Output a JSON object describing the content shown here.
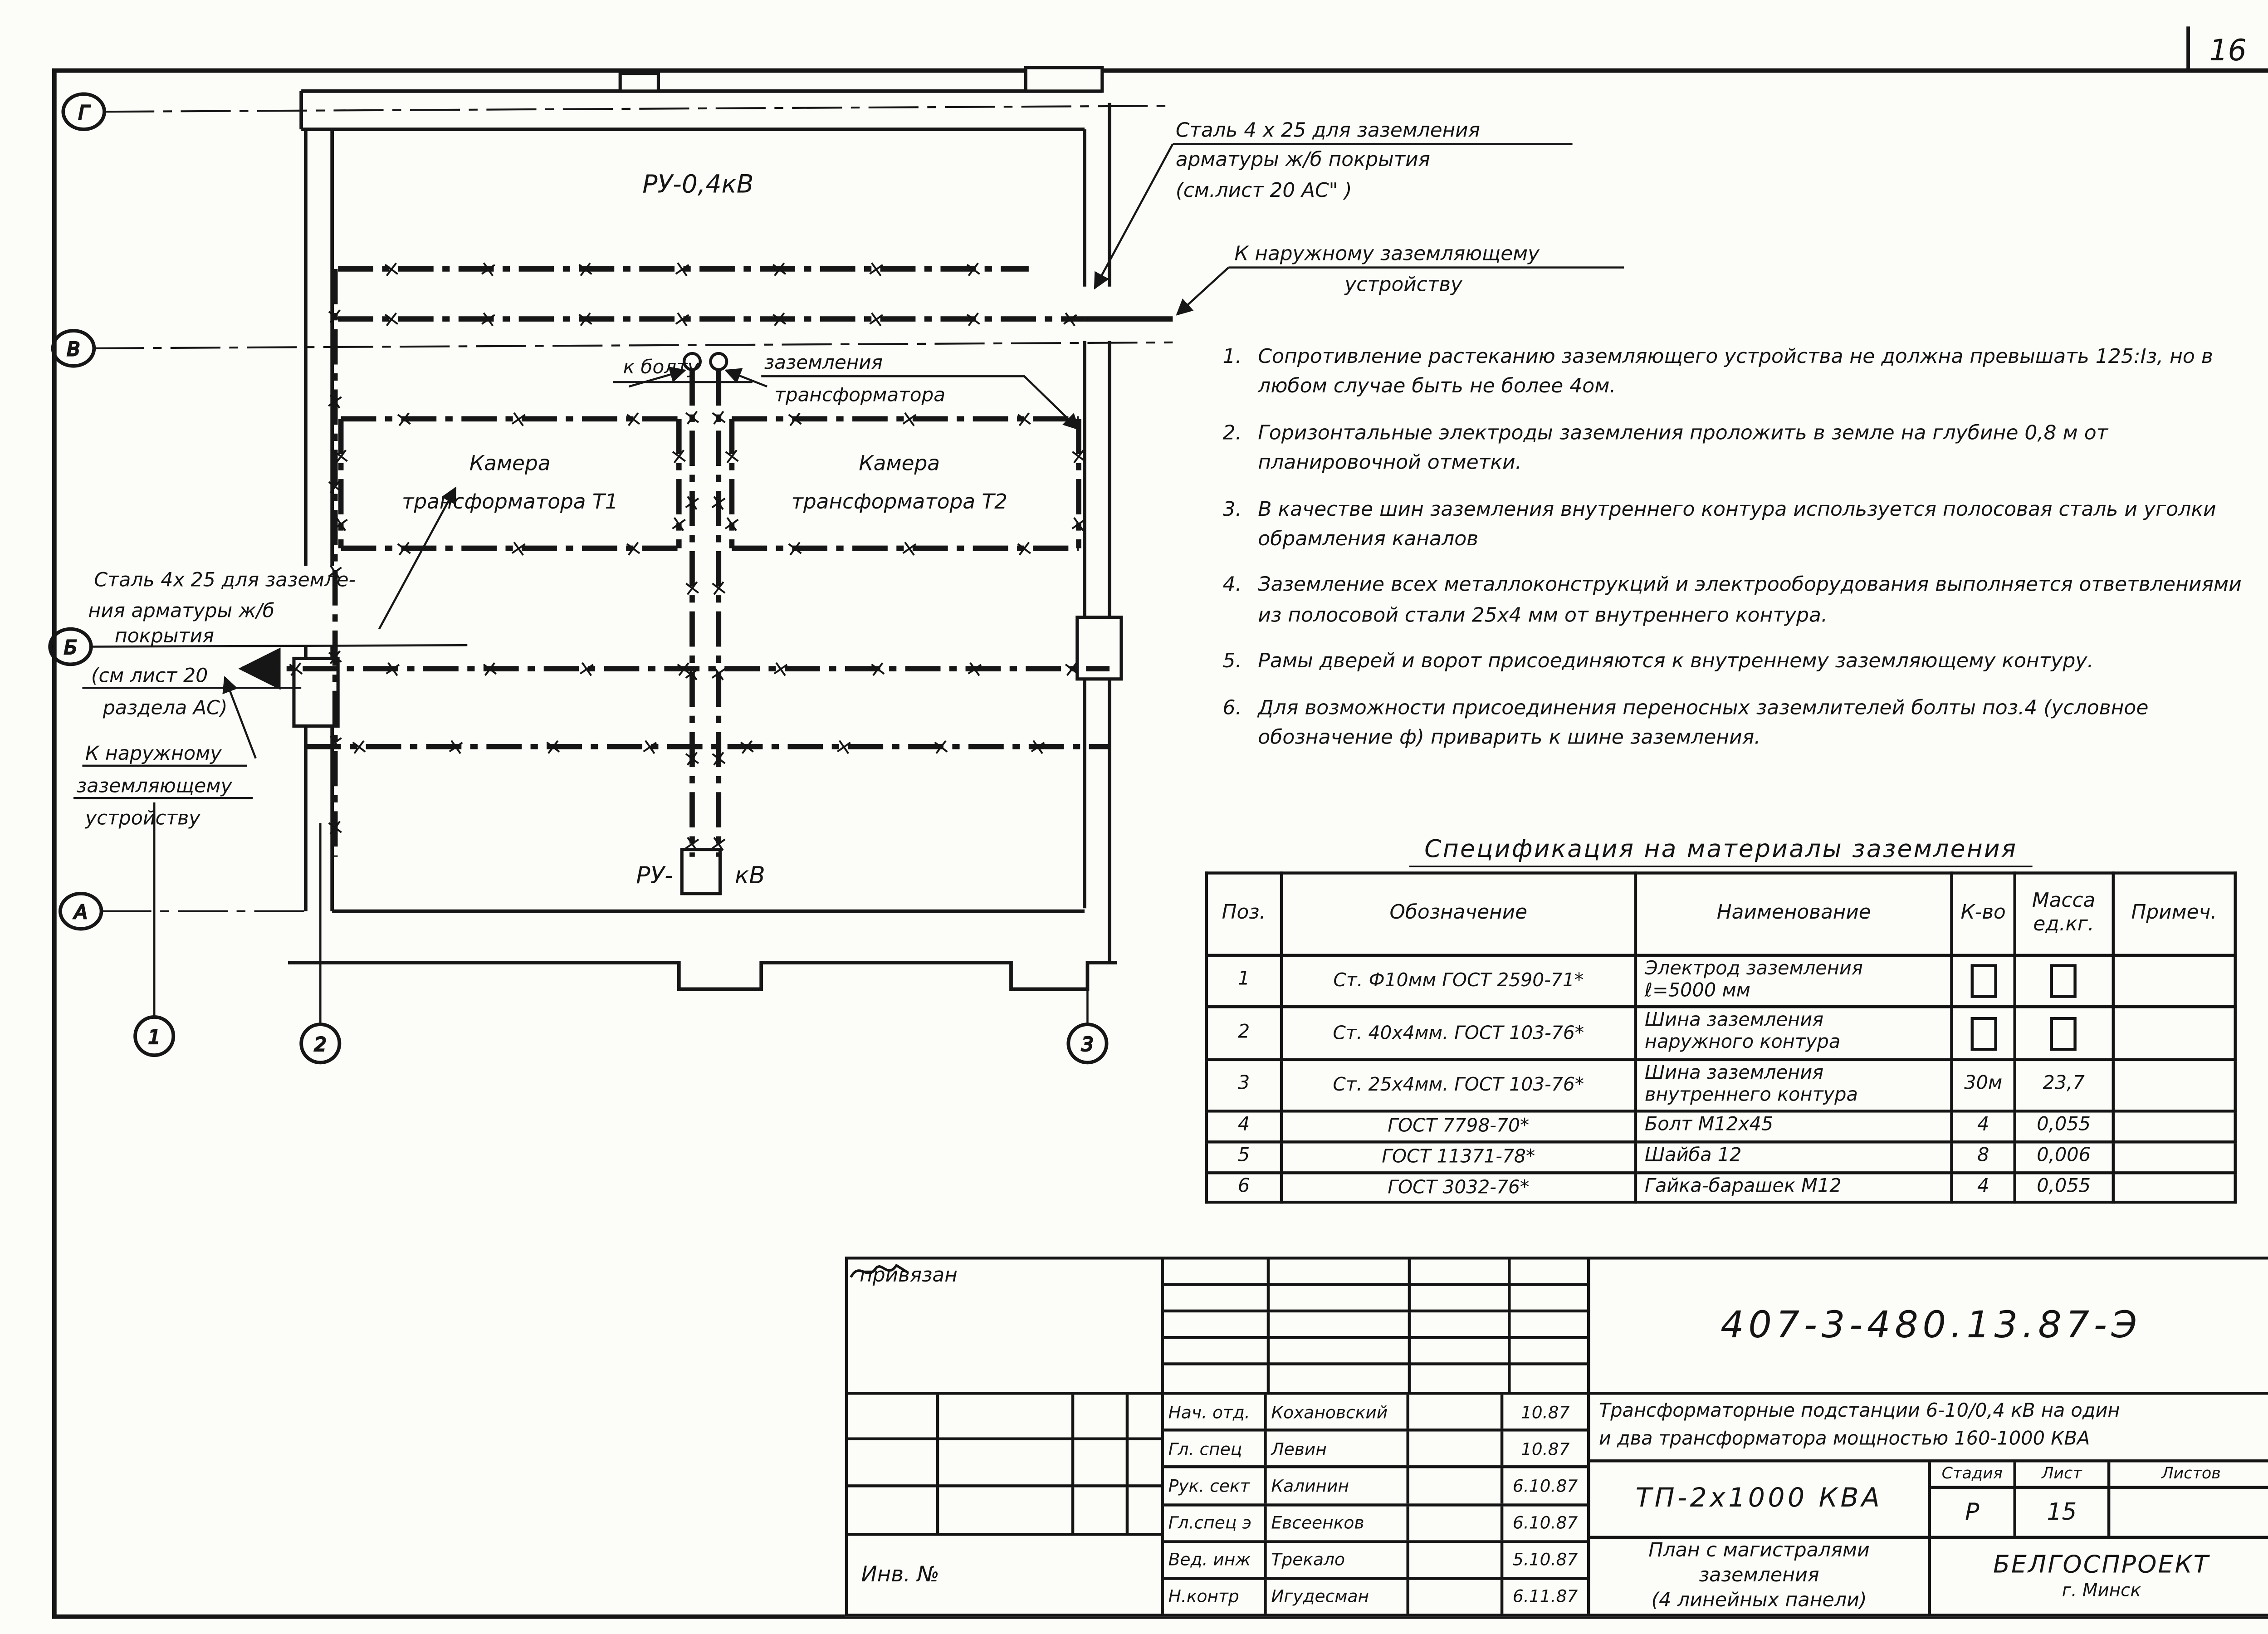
{
  "sheet": {
    "page_number": "16"
  },
  "plan": {
    "room_top_label": "РУ-0,4кВ",
    "room_bottom_prefix": "РУ-",
    "room_bottom_suffix": "кВ",
    "chambers": [
      {
        "line1": "Камера",
        "line2": "трансформатора   Т1"
      },
      {
        "line1": "Камера",
        "line2": "трансформатора   Т2"
      }
    ],
    "bolt_callout": {
      "part1": "к болту",
      "part2": "заземления",
      "part3": "трансформатора"
    },
    "steel_callout_right": [
      "Сталь 4 х 25 для заземления",
      "арматуры  ж/б  покрытия",
      "(см.лист 20 АС\"      )"
    ],
    "external_callout_right": [
      "К наружному заземляющему",
      "устройству"
    ],
    "steel_callout_left": [
      "Сталь 4х 25 для заземле-",
      "ния арматуры  ж/б",
      "покрытия",
      "(см  лист 20",
      "раздела АС)"
    ],
    "external_callout_left": [
      "К наружному",
      "заземляющему",
      "устройству"
    ],
    "axes_rows": [
      "Г",
      "В",
      "Б",
      "А"
    ],
    "axes_cols": [
      "1",
      "2",
      "3"
    ]
  },
  "notes": [
    {
      "num": "1.",
      "text": "Сопротивление растеканию заземляющего устройства не должна превы­шать 125:Iз, но в любом случае быть не более 4ом."
    },
    {
      "num": "2.",
      "text": "Горизонтальные электроды заземления проложить в земле на глубине 0,8 м от планировочной отметки."
    },
    {
      "num": "3.",
      "text": "В качестве шин заземления внутреннего контура использу­ется полосовая сталь и уголки обрамления каналов"
    },
    {
      "num": "4.",
      "text": "Заземление всех металлоконструкций и электрооборудования выполняется ответвлениями из полосовой стали 25х4 мм от внутреннего контура."
    },
    {
      "num": "5.",
      "text": "Рамы дверей и ворот присоединяются к внутреннему заземляющему контуру."
    },
    {
      "num": "6.",
      "text": "Для возможности присоединения переносных заземлителей болты поз.4 (условное обозначение ф) приварить к шине заземления."
    }
  ],
  "spec": {
    "title": "Спецификация  на  материалы  заземления",
    "headers": [
      "Поз.",
      "Обозначение",
      "Наименование",
      "К-во",
      "Масса\nед.кг.",
      "Примеч."
    ],
    "rows": [
      {
        "pos": "1",
        "designation": "Ст. Ф10мм ГОСТ 2590-71*",
        "name": "Электрод заземления\nℓ=5000 мм",
        "qty": "",
        "mass": "",
        "note": "",
        "qty_box": true,
        "mass_box": true
      },
      {
        "pos": "2",
        "designation": "Ст. 40х4мм. ГОСТ 103-76*",
        "name": "Шина заземления\nнаружного  контура",
        "qty": "",
        "mass": "",
        "note": "",
        "qty_box": true,
        "mass_box": true
      },
      {
        "pos": "3",
        "designation": "Ст. 25х4мм. ГОСТ 103-76*",
        "name": "Шина заземления\nвнутреннего контура",
        "qty": "30м",
        "mass": "23,7",
        "note": "",
        "qty_box": false,
        "mass_box": false
      },
      {
        "pos": "4",
        "designation": "ГОСТ 7798-70*",
        "name": "Болт М12х45",
        "qty": "4",
        "mass": "0,055",
        "note": "",
        "qty_box": false,
        "mass_box": false
      },
      {
        "pos": "5",
        "designation": "ГОСТ 11371-78*",
        "name": "Шайба 12",
        "qty": "8",
        "mass": "0,006",
        "note": "",
        "qty_box": false,
        "mass_box": false
      },
      {
        "pos": "6",
        "designation": "ГОСТ 3032-76*",
        "name": "Гайка-барашек М12",
        "qty": "4",
        "mass": "0,055",
        "note": "",
        "qty_box": false,
        "mass_box": false
      }
    ]
  },
  "title_block": {
    "doc_number": "407-3-480.13.87-Э",
    "description_line1": "Трансформаторные подстанции 6-10/0,4 кВ на один",
    "description_line2": "и два  трансформатора мощностью 160-1000 КВА",
    "object_label": "ТП-2х1000 КВА",
    "sheet_title_line1": "План с  магистралями",
    "sheet_title_line2": "заземления",
    "sheet_title_line3": "(4 линейных  панели)",
    "stage_label": "Стадия",
    "sheet_label": "Лист",
    "sheets_label": "Листов",
    "stage_value": "Р",
    "sheet_value": "15",
    "sheets_value": "",
    "org_name": "БЕЛГОСПРОЕКТ",
    "org_city": "г. Минск",
    "binding_note": "привязан",
    "inventory_label": "Инв. №",
    "signatures": [
      {
        "role": "Нач. отд.",
        "name": "Кохановский",
        "date": "10.87"
      },
      {
        "role": "Гл. спец",
        "name": "Левин",
        "date": "10.87"
      },
      {
        "role": "Рук. сект",
        "name": "Калинин",
        "date": "6.10.87"
      },
      {
        "role": "Гл.спец э",
        "name": "Евсеенков",
        "date": "6.10.87"
      },
      {
        "role": "Вед. инж",
        "name": "Трекало",
        "date": "5.10.87"
      },
      {
        "role": "Н.контр",
        "name": "Игудесман",
        "date": "6.11.87"
      }
    ]
  }
}
